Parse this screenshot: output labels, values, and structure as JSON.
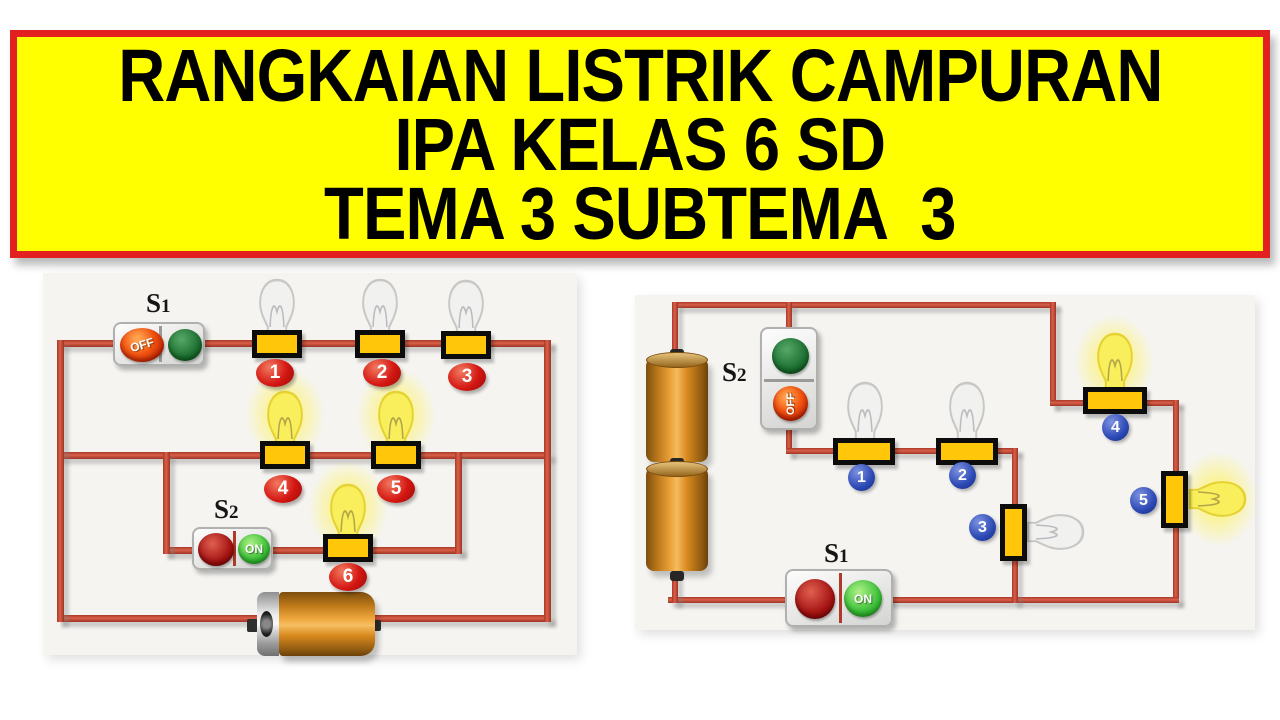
{
  "banner": {
    "line1": "RANGKAIAN LISTRIK CAMPURAN",
    "line2": "IPA KELAS 6 SD",
    "line3": "TEMA 3 SUBTEMA  3",
    "bg_color": "#ffff00",
    "border_color": "#e32020",
    "text_color": "#000000"
  },
  "left_circuit": {
    "switch_s1": {
      "label_base": "S",
      "label_sub": "1",
      "button_text": "OFF",
      "state": "off"
    },
    "switch_s2": {
      "label_base": "S",
      "label_sub": "2",
      "button_text": "ON",
      "state": "on"
    },
    "bulbs": [
      {
        "number": "1",
        "state": "unlit"
      },
      {
        "number": "2",
        "state": "unlit"
      },
      {
        "number": "3",
        "state": "unlit"
      },
      {
        "number": "4",
        "state": "lit"
      },
      {
        "number": "5",
        "state": "lit"
      },
      {
        "number": "6",
        "state": "lit"
      }
    ],
    "badge_color": "#d41712"
  },
  "right_circuit": {
    "switch_s2": {
      "label_base": "S",
      "label_sub": "2",
      "button_text": "OFF",
      "state": "off"
    },
    "switch_s1": {
      "label_base": "S",
      "label_sub": "1",
      "button_text": "ON",
      "state": "on"
    },
    "bulbs": [
      {
        "number": "1",
        "state": "unlit"
      },
      {
        "number": "2",
        "state": "unlit"
      },
      {
        "number": "3",
        "state": "unlit"
      },
      {
        "number": "4",
        "state": "lit"
      },
      {
        "number": "5",
        "state": "lit"
      }
    ],
    "badge_color": "#2c49b4"
  },
  "colors": {
    "wire": "#c4462f",
    "lamp_holder_fill": "#ffc60a",
    "lamp_holder_border": "#0c0c0c",
    "battery_orange": "#d98a1e",
    "lit_bulb": "#f9ef5c",
    "unlit_bulb": "#f1f1ef",
    "panel_bg": "#f5f4f1"
  }
}
